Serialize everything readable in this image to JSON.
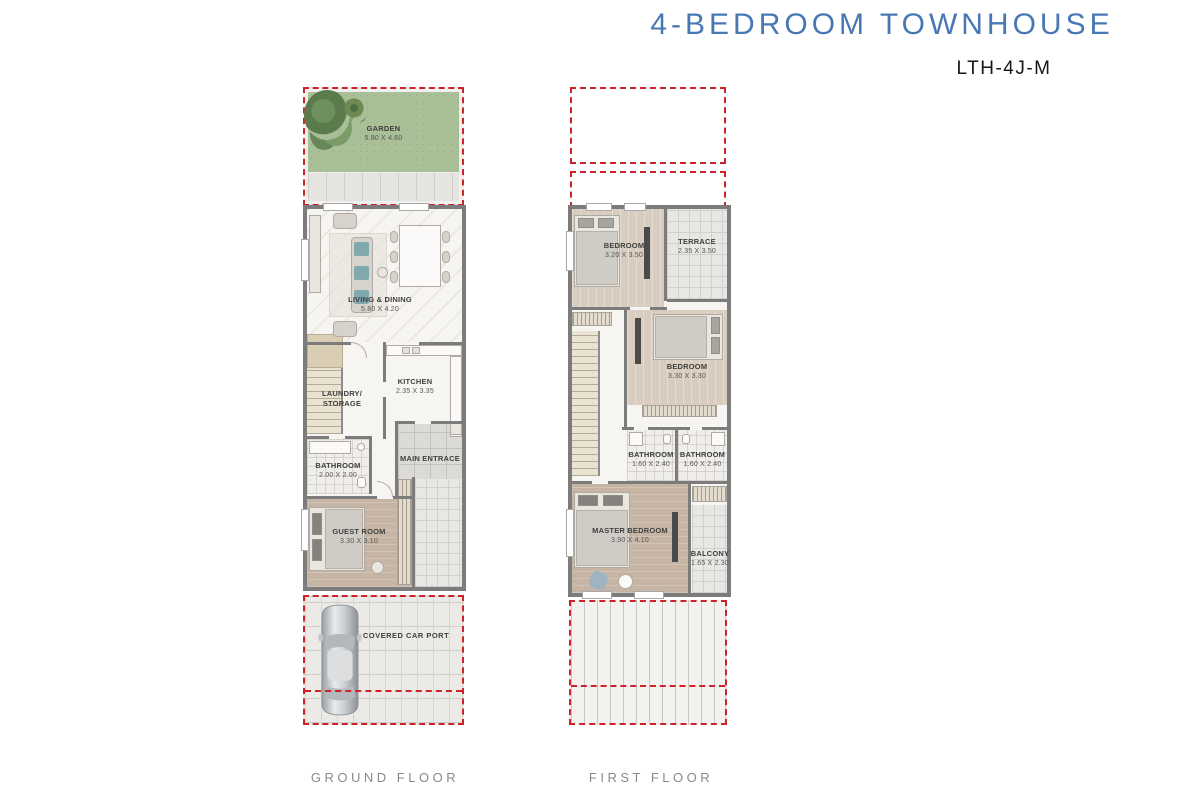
{
  "header": {
    "title": "4-BEDROOM TOWNHOUSE",
    "unit_code": "LTH-4J-M"
  },
  "ground_floor": {
    "label": "GROUND FLOOR",
    "rooms": [
      {
        "name": "GARDEN",
        "dims": "5.80 X 4.60"
      },
      {
        "name": "LIVING & DINING",
        "dims": "5.80 X 4.20"
      },
      {
        "name": "KITCHEN",
        "dims": "2.35 X 3.35"
      },
      {
        "name": "LAUNDRY/ STORAGE",
        "dims": ""
      },
      {
        "name": "BATHROOM",
        "dims": "2.00 X 2.00"
      },
      {
        "name": "MAIN ENTRACE",
        "dims": ""
      },
      {
        "name": "GUEST ROOM",
        "dims": "3.30 X 3.10"
      },
      {
        "name": "COVERED CAR PORT",
        "dims": ""
      }
    ]
  },
  "first_floor": {
    "label": "FIRST FLOOR",
    "rooms": [
      {
        "name": "BEDROOM",
        "dims": "3.20 X 3.50"
      },
      {
        "name": "TERRACE",
        "dims": "2.35 X 3.50"
      },
      {
        "name": "BEDROOM",
        "dims": "3.30 X 3.30"
      },
      {
        "name": "BATHROOM",
        "dims": "1.60 X 2.40"
      },
      {
        "name": "BATHROOM",
        "dims": "1.60 X 2.40"
      },
      {
        "name": "MASTER BEDROOM",
        "dims": "3.90 X 4.10"
      },
      {
        "name": "BALCONY",
        "dims": "1.65 X 2.30"
      }
    ]
  },
  "colors": {
    "title_blue": "#4878b4",
    "boundary_red": "#cc2229",
    "wall_gray": "#7c7c7c",
    "garden_green": "#a8bf98",
    "label_gray": "#8a8a8a"
  }
}
